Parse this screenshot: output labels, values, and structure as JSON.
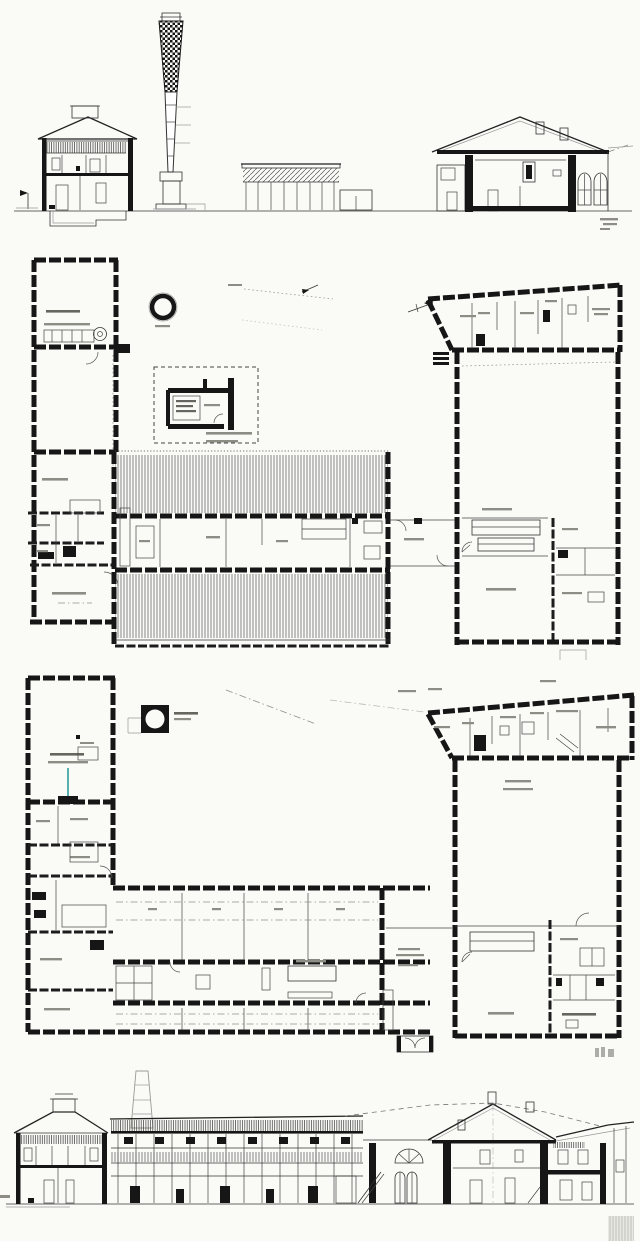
{
  "page": {
    "paper_color": "#fafaf7",
    "ink_color": "#161616",
    "accent_mark_color": "#2f9d9b",
    "content_kind": "scanned architectural drawing sheet, no legible text labels"
  },
  "drawings": [
    {
      "id": "top-section",
      "name": "cross section elevation with boiler house and tall brick chimney",
      "kind": "section-elevation"
    },
    {
      "id": "upper-plan",
      "name": "upper floor plan of L-shaped factory complex with hatched shed roofs",
      "kind": "floor-plan"
    },
    {
      "id": "lower-plan",
      "name": "ground floor plan of L-shaped factory complex with room partitions",
      "kind": "floor-plan"
    },
    {
      "id": "bottom-section",
      "name": "longitudinal section through shed hall and entrance pavilion",
      "kind": "section-elevation"
    }
  ]
}
